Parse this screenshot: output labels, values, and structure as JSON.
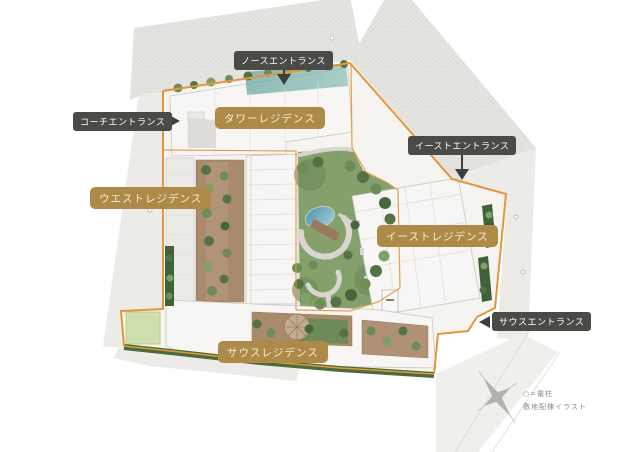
{
  "plan": {
    "residences": {
      "tower": "タワーレジデンス",
      "west": "ウエストレジデンス",
      "east": "イーストレジデンス",
      "south": "サウスレジデンス"
    },
    "entrances": {
      "north": "ノースエントランス",
      "coach": "コーチエントランス",
      "east": "イーストエントランス",
      "south": "サウスエントランス"
    }
  },
  "caption": {
    "legend": "○=電柱",
    "title": "敷地配棟イラスト"
  },
  "colors": {
    "residence_label_bg": "#ad8a47",
    "residence_label_text": "#f5edd6",
    "entrance_label_bg": "#4a4a47",
    "entrance_label_text": "#ffffff",
    "site_boundary": "#e2973d"
  }
}
